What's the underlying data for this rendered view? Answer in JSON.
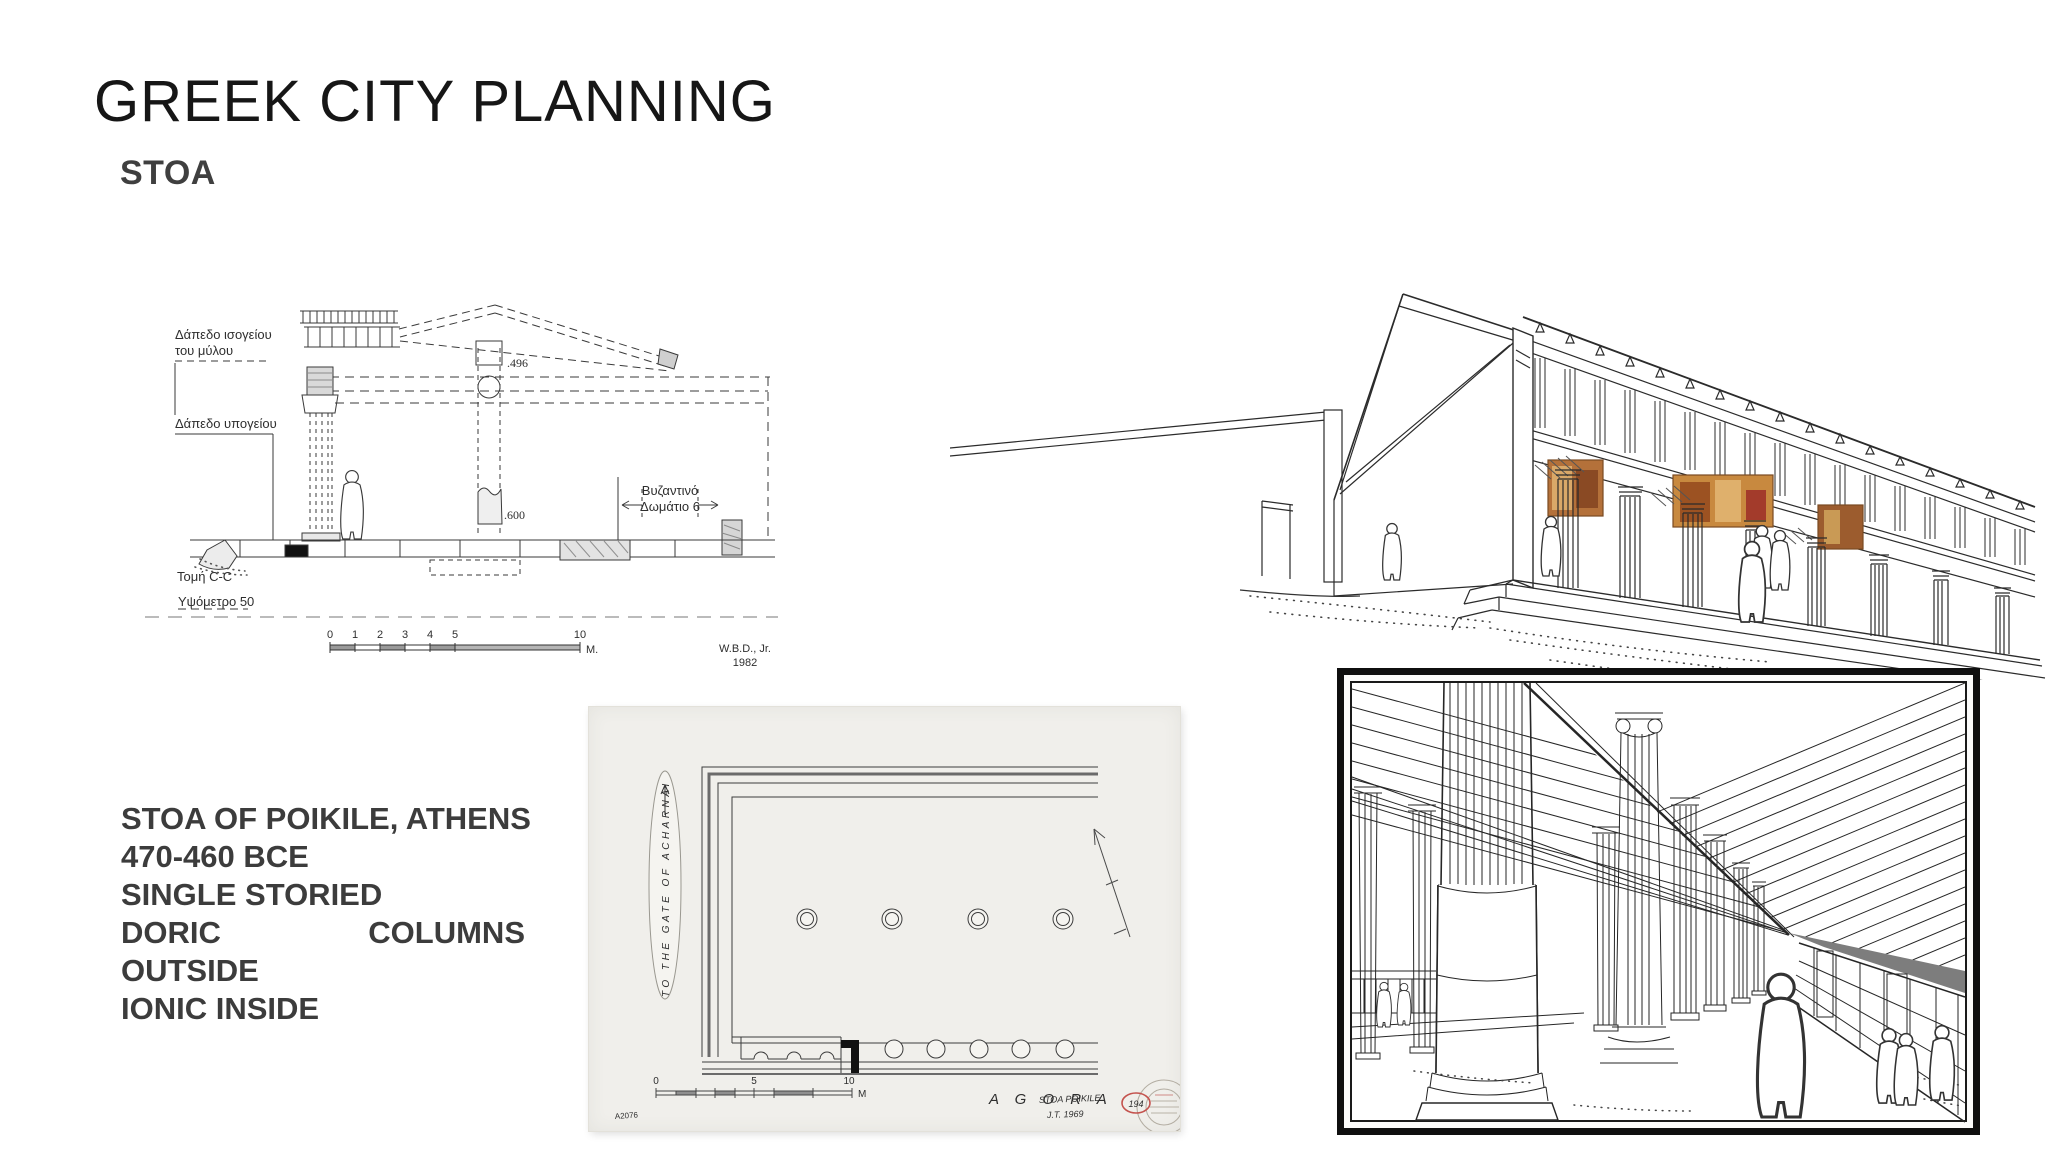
{
  "slide": {
    "title": "GREEK CITY PLANNING",
    "subtitle": "STOA",
    "background_color": "#ffffff",
    "title_color": "#161616",
    "body_text_color": "#3c3c3c"
  },
  "info_block": {
    "line1": "STOA OF POIKILE, ATHENS",
    "line2": "470-460 BCE",
    "line3": "SINGLE STORIED",
    "line4_left": "DORIC",
    "line4_right": "COLUMNS",
    "line5": "OUTSIDE",
    "line6": "IONIC INSIDE"
  },
  "section_drawing": {
    "labels": {
      "ground_floor_line1": "Δάπεδο ισογείου",
      "ground_floor_line2": "του μύλου",
      "basement": "Δάπεδο υπογείου",
      "byzantine_line1": "Βυζαντινό",
      "byzantine_line2": "Δωμάτιο 6",
      "dim_496": ".496",
      "dim_600": ".600",
      "section_cut": "Τομή C-C",
      "elevation": "Υψόμετρο  50"
    },
    "scale": {
      "ticks": [
        "0",
        "1",
        "2",
        "3",
        "4",
        "5"
      ],
      "end": "10",
      "unit": "M."
    },
    "credit": {
      "line1": "W.B.D., Jr.",
      "line2": "1982"
    }
  },
  "floor_plan": {
    "paper_color": "#f0efeb",
    "gate_label": "TO THE GATE OF ACHARNAI",
    "agora_label": "A G O R A",
    "scale": {
      "zero": "0",
      "five": "5",
      "ten": "10",
      "unit": "M"
    },
    "sheet_number": "A2076",
    "red_note_line1": "STOA  POIKILE",
    "red_note_line2": "J.T.  1969",
    "red_badge": "194",
    "red_color": "#c4534e"
  },
  "exterior_drawing": {
    "ink_color": "#2b2b2b",
    "painting_panel_colors": [
      "#b4713a",
      "#c8893f",
      "#9c5c2e",
      "#a33b2b",
      "#dfb06c"
    ]
  },
  "interior_drawing": {
    "ink_color": "#262626",
    "frame_color": "#0f0f0f"
  }
}
